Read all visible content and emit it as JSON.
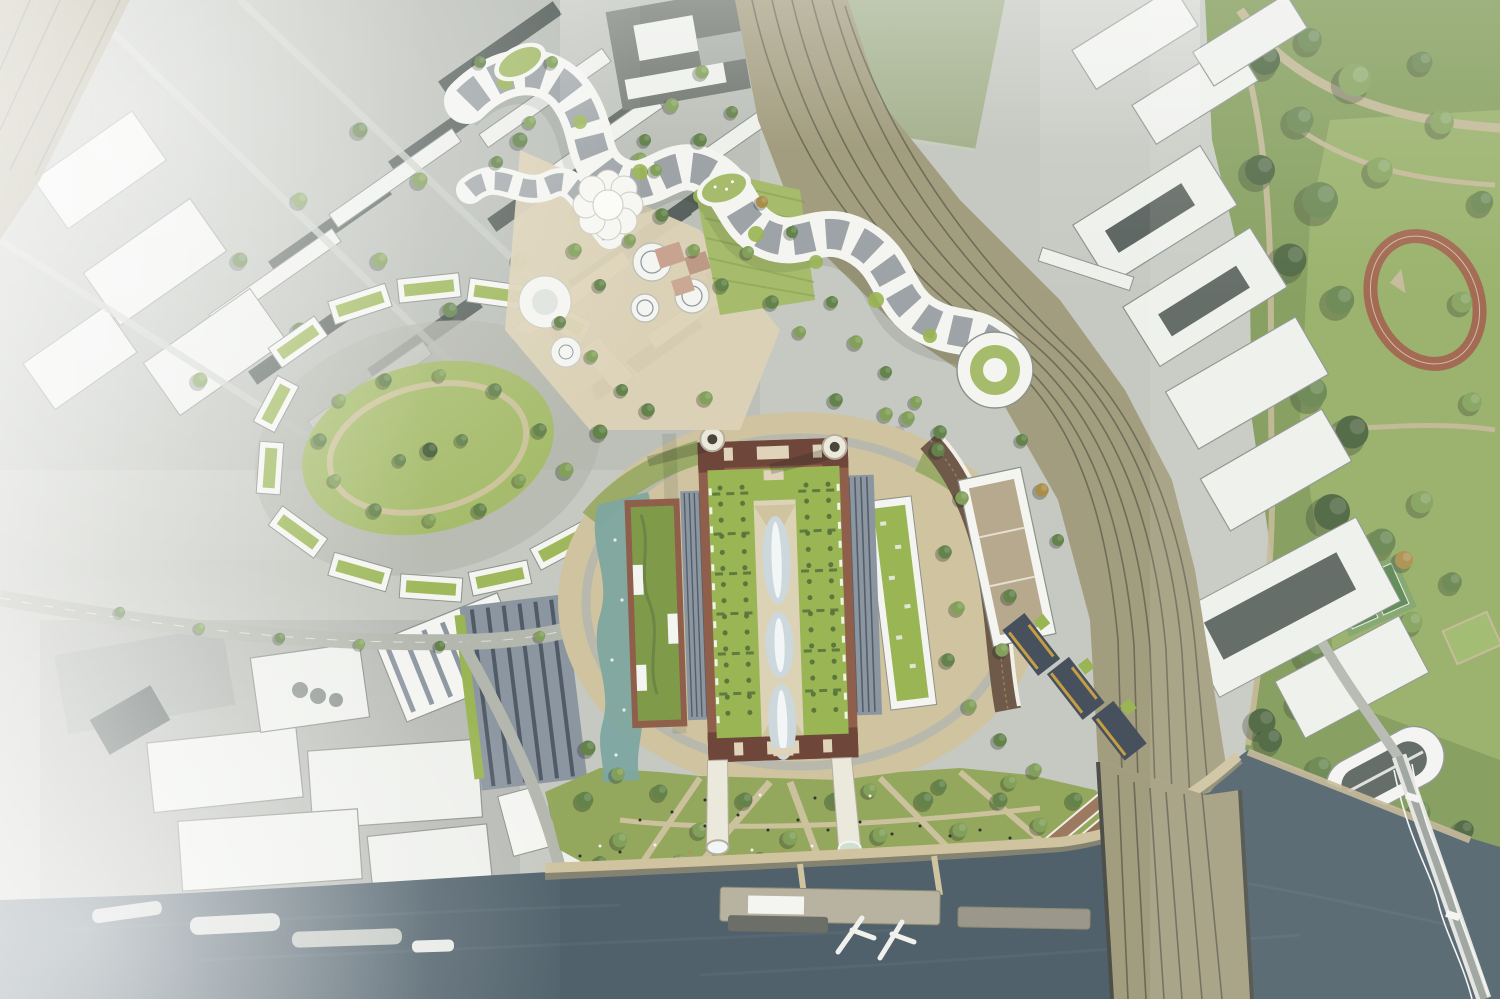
{
  "scene": {
    "description": "Aerial architectural rendering of a riverside power-station masterplan: restored four-chimney brick power station with green roof and three glass lens domes, circular tree-lined promenade, riverside event lawn with jetty pier and two cranes on the Thames, serpentine white residential terraces with roof gardens to the north, an oval garden square to the west, railway corridors crossing the river on a rail bridge, a suspension road bridge at lower right, a large public park with running track and tennis courts on the right, and desaturated existing city blocks and industrial yards fading into haze around the edges.",
    "regions": [
      "river-thames",
      "riverside-lawn",
      "river-pier",
      "pier-cranes",
      "boats",
      "power-station",
      "power-station-chimneys",
      "glass-domes",
      "green-roof",
      "circular-promenade",
      "water-garden",
      "east-annexes",
      "crescent-building",
      "amber-terraces",
      "serpentine-terraces",
      "flower-tower",
      "roof-garden-ovals",
      "central-plaza",
      "oval-garden-square",
      "development-west",
      "railway-corridor",
      "rail-river-bridge",
      "suspension-bridge",
      "public-park",
      "running-track",
      "tennis-courts",
      "context-city-blocks",
      "industrial-yards",
      "sports-field",
      "haze"
    ],
    "counts": {
      "chimneys": 4,
      "glass_domes": 3,
      "pier_cranes": 2,
      "boats": 4,
      "bridges": 2
    }
  },
  "palette": {
    "c-river": "#50616b",
    "c-waterLight": "#66767f",
    "c-shore": "#8d8a73",
    "c-beach": "#c3b695",
    "c-lawn": "#93a75d",
    "c-lawnB": "#a6bc6c",
    "c-park": "#7e9a55",
    "c-parkOpen": "#93ad62",
    "c-path": "#cfc3a0",
    "c-plaza": "#dcd2b6",
    "c-road": "#b4b7ae",
    "c-rail": "#a39d7f",
    "c-railLine": "#5c5d4c",
    "c-brick": "#8f5f4b",
    "c-brickD": "#6f463a",
    "c-cream": "#dfd3ba",
    "c-chim": "#ebe8dc",
    "c-dome": "#cdd8dd",
    "c-domeHi": "#f3f6f6",
    "c-roofG": "#9ab553",
    "c-roofGD": "#7f9b49",
    "c-hedge": "#55713c",
    "c-teal": "#7da7a0",
    "c-white": "#f4f5f1",
    "c-shed": "#eef0ec",
    "c-gray1": "#c6c9c2",
    "c-gray2": "#a9aea8",
    "c-gray3": "#8b918c",
    "c-grayD": "#59625e",
    "c-glassD": "#46515d",
    "c-glassM": "#8c96a1",
    "c-amber": "#c59d42",
    "c-terr": "#9c5f45",
    "c-treeD": "#47613a",
    "c-treeM": "#64834b",
    "c-treeL": "#82a05a",
    "c-treeO": "#a98e4a",
    "c-crescent": "#6f5a49",
    "c-crescentHi": "#a08868",
    "c-gravel": "#b7a98e",
    "c-field": "#a3b18c",
    "c-pinkB": "#c8a38f",
    "c-fog": "#ffffff"
  }
}
